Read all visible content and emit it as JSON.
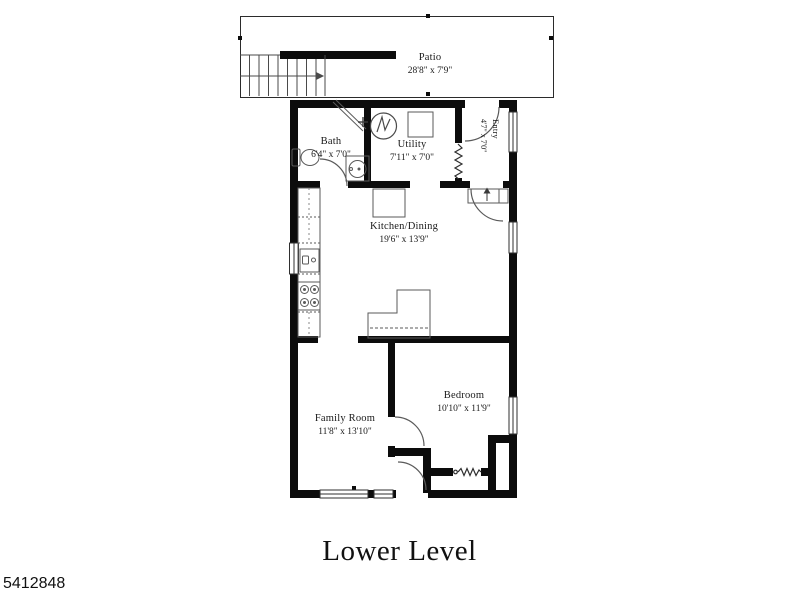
{
  "title": "Lower Level",
  "photo_id": "5412848",
  "rooms": {
    "patio": {
      "name": "Patio",
      "dims": "28'8\" x 7'9\""
    },
    "bath": {
      "name": "Bath",
      "dims": "6'4\" x 7'0\""
    },
    "utility": {
      "name": "Utility",
      "dims": "7'11\" x 7'0\""
    },
    "entry": {
      "name": "Entry",
      "dims": "4'7\" x 7'0\""
    },
    "kitchen": {
      "name": "Kitchen/Dining",
      "dims": "19'6\" x 13'9\""
    },
    "family_room": {
      "name": "Family Room",
      "dims": "11'8\" x 13'10\""
    },
    "bedroom": {
      "name": "Bedroom",
      "dims": "10'10\" x 11'9\""
    }
  },
  "colors": {
    "wall": "#0c0c0c",
    "fixture_line": "#555555",
    "background": "#ffffff",
    "text": "#1a1a1a"
  },
  "icons": [
    "stairs",
    "up-arrow",
    "washer",
    "furnace",
    "toilet",
    "bath-sink",
    "kitchen-sink",
    "stove",
    "refrigerator",
    "window",
    "door-swing",
    "radiator",
    "accordion-door"
  ]
}
